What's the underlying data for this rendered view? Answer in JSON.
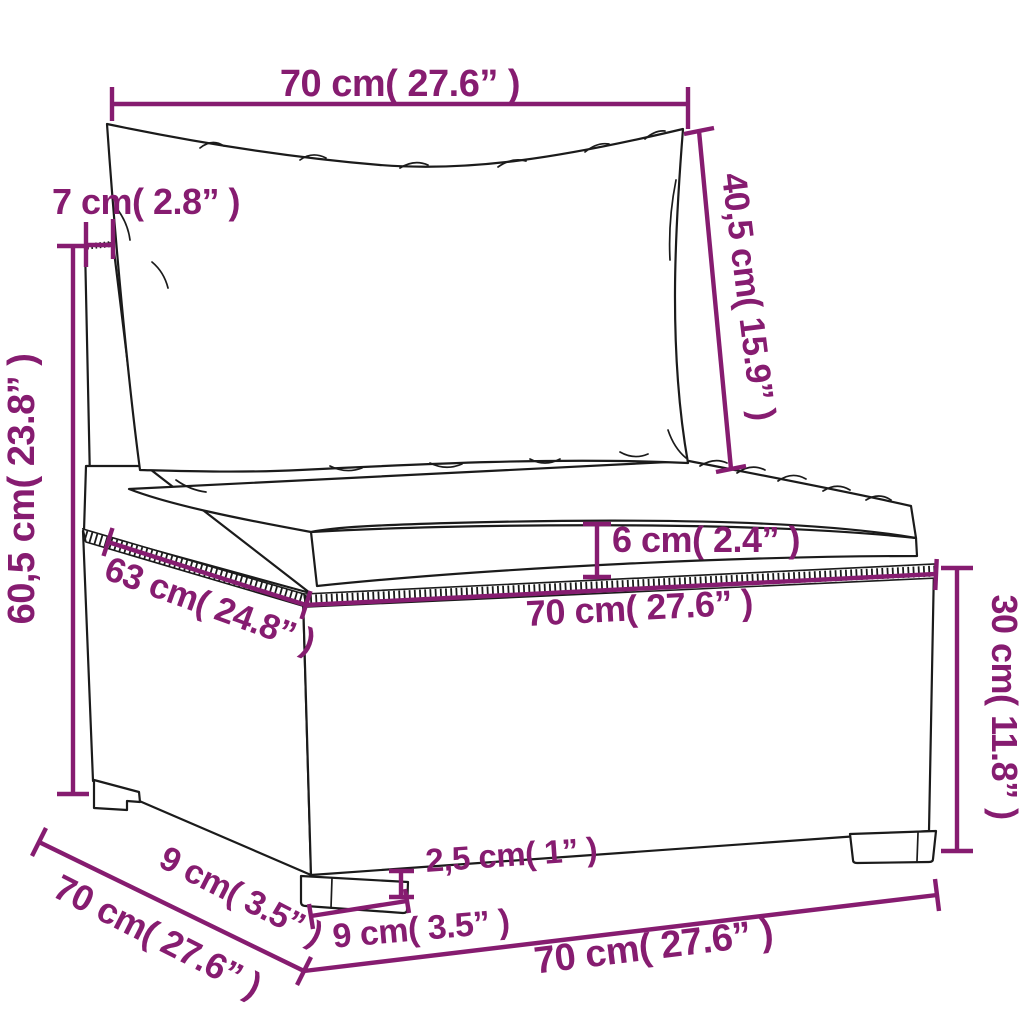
{
  "figure": {
    "description": "Dimension line drawing of a poly rattan garden middle sofa section with back cushion and seat cushion",
    "style": {
      "annotation_color": "#861C70",
      "line_color": "#1b1b1b",
      "background_color": "#ffffff"
    }
  },
  "dimensions": [
    {
      "id": "back-cushion-width",
      "label": "70 cm( 27.6” )"
    },
    {
      "id": "backrest-thickness",
      "label": "7 cm( 2.8” )"
    },
    {
      "id": "back-cushion-height",
      "label": "40,5 cm( 15.9” )"
    },
    {
      "id": "total-height",
      "label": "60,5 cm( 23.8” )"
    },
    {
      "id": "seat-cushion-thickness",
      "label": "6 cm( 2.4” )"
    },
    {
      "id": "seat-depth",
      "label": "63 cm( 24.8” )"
    },
    {
      "id": "seat-width",
      "label": "70 cm( 27.6” )"
    },
    {
      "id": "base-height",
      "label": "30 cm( 11.8” )"
    },
    {
      "id": "leg-height",
      "label": "2,5 cm( 1” )"
    },
    {
      "id": "leg-width",
      "label": "9 cm( 3.5” )"
    },
    {
      "id": "leg-depth",
      "label": "9 cm( 3.5” )"
    },
    {
      "id": "total-depth",
      "label": "70 cm( 27.6” )"
    },
    {
      "id": "base-width",
      "label": "70 cm( 27.6” )"
    }
  ]
}
